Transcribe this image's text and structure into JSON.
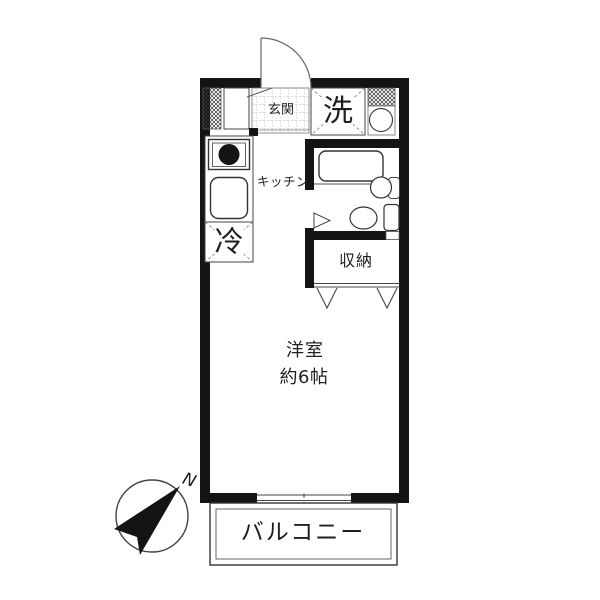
{
  "floorplan": {
    "type": "studio-apartment-floor-plan",
    "labels": {
      "entrance": "玄関",
      "washing_machine": "洗",
      "kitchen": "キッチン",
      "refrigerator": "冷",
      "storage": "収納",
      "room_name": "洋室",
      "room_size": "約6帖",
      "balcony": "バルコニー",
      "compass_north": "N"
    },
    "colors": {
      "wall": "#141414",
      "fixture_line": "#3a3a3a",
      "text": "#1f1f1f",
      "background": "#ffffff"
    }
  }
}
